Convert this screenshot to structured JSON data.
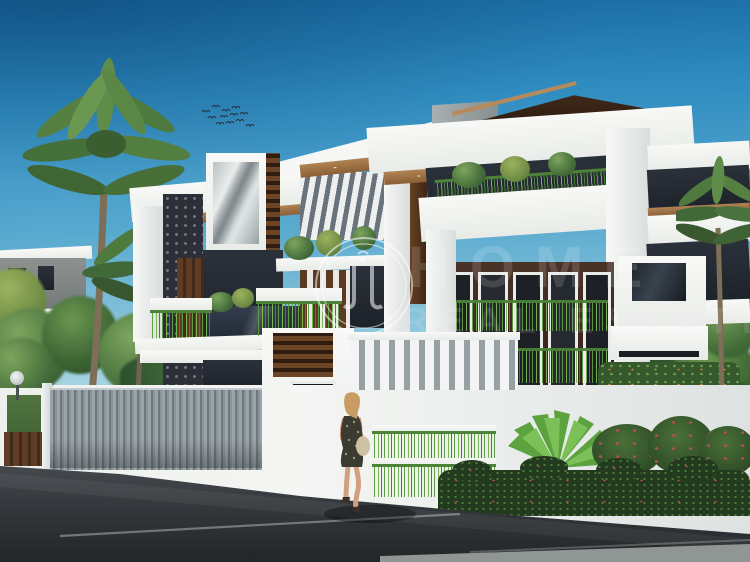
{
  "image": {
    "type": "3d-architectural-rendering",
    "subject": "Ultra-modern two-storey white villa with dark wood accents, compound wall, palms, street and pedestrian",
    "width_px": 750,
    "height_px": 562
  },
  "watermark": {
    "logo": "double-ring calligraphy emblem",
    "line1": "HOME",
    "line2": "REAL ESTATE"
  },
  "palette": {
    "sky_top": "#17689f",
    "sky_horizon": "#e7f4f4",
    "wall_white": "#f3f4f2",
    "wall_shadow": "#c9cfd1",
    "roof_dark": "#241709",
    "wood_soffit": "#a57a49",
    "wood_panel": "#5d3b22",
    "wall_charcoal": "#262b33",
    "foliage_dark": "#3f6a38",
    "foliage_bright": "#6fb24f",
    "hedge_green": "#223a1d",
    "flower_red": "#b64055",
    "fence_slat_gray": "#8f989e",
    "road_asphalt": "#33373b",
    "flare_orange": "#ffb261",
    "skin": "#d2a07f",
    "hair_blonde": "#c99c63",
    "dress_dark": "#3b3b31",
    "bag_tan": "#cec1a3"
  },
  "scene": {
    "birds_in_sky": 12,
    "palm_trees_left": 2,
    "palm_trees_right": 1,
    "pedestrians": 1,
    "vehicles": 0
  }
}
